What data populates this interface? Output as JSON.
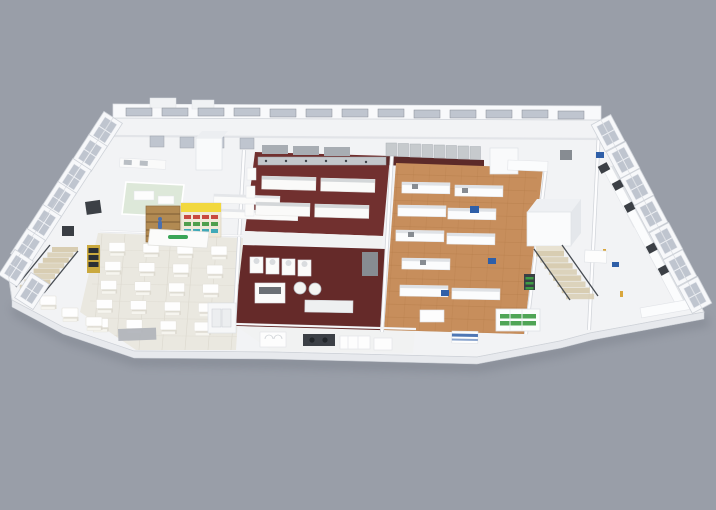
{
  "scene": {
    "type": "isometric-3d-floorplan-render",
    "background": "#999ea8"
  },
  "colors": {
    "bg": "#999ea8",
    "slab": "#f2f3f5",
    "slab_stroke": "#d7dade",
    "front_wall": "#e7e9ed",
    "back_wall": "#f8f9fb",
    "glass": "#bfc5cf",
    "frame": "#70757e",
    "shadow": "#767b86",
    "maroon_upper": "#71302f",
    "maroon_lower": "#652a29",
    "maroon_strip": "#5c2a29",
    "corridor": "#f1f2f2",
    "dining_floor": "#eae8e0",
    "dining_line": "#dcd9cf",
    "mint": "#dde8d9",
    "wood": "#c78e5c",
    "wood_line": "#b27a48",
    "stainless": "#c3c7cb",
    "steel_mid": "#a8adb3",
    "steel_dark": "#878c92",
    "equip_dark": "#3c4046",
    "kiosk_yellow": "#f2d83e",
    "kiosk_wood": "#b28a52",
    "kiosk_wood_line": "#7c5c34",
    "product_red": "#c8493f",
    "product_green": "#4f9e4e",
    "product_teal": "#3fa9b8",
    "logo_green": "#3aa558",
    "accent_blue": "#2f5fa8",
    "person_blue": "#4a6fae",
    "stair_tread": "#d8cdb2",
    "stair_tread_alt": "#ccc1a5",
    "rail_dark": "#474c52",
    "plant_green": "#3e9c44",
    "marker_yellow": "#d9a63c",
    "mat_gray": "#afb3b9",
    "shelf_frame_yellow": "#caa93e",
    "table_white": "#fefefe",
    "table_shadow": "#d9d6cc"
  },
  "regions": [
    {
      "name": "entry-lounge",
      "floor": "slab"
    },
    {
      "name": "dining-hall",
      "floor": "dining_floor",
      "tables": 20
    },
    {
      "name": "retail-kiosk",
      "floor": "slab"
    },
    {
      "name": "teaching-labs-left",
      "floor": "slab"
    },
    {
      "name": "mint-room",
      "floor": "mint"
    },
    {
      "name": "training-kitchen-upper",
      "floor": "maroon_upper",
      "benches": 4
    },
    {
      "name": "training-kitchen-lower",
      "floor": "maroon_lower"
    },
    {
      "name": "servery-line",
      "floor": "corridor"
    },
    {
      "name": "food-processing-lab",
      "floor": "wood"
    },
    {
      "name": "cold-room-box",
      "floor": "slab"
    },
    {
      "name": "stairwell-left",
      "steps": 8
    },
    {
      "name": "stairwell-right",
      "steps": 8
    },
    {
      "name": "analysis-wing-right",
      "floor": "slab",
      "window_bays": 7
    },
    {
      "name": "facade-window-bays-left",
      "window_bays": 8
    }
  ]
}
